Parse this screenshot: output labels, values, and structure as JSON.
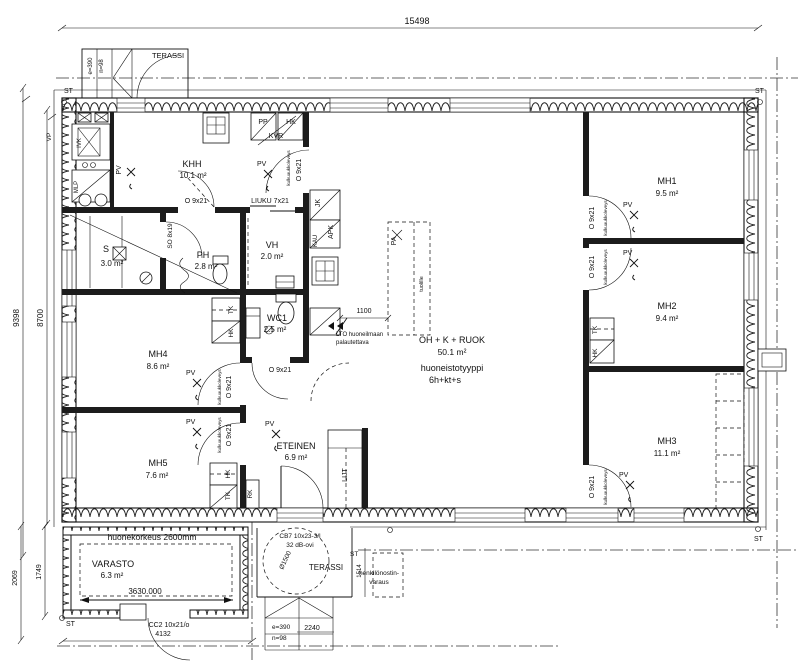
{
  "plan": {
    "dims": {
      "top": "15498",
      "left_outer": "9398",
      "left_inner": "8700",
      "bl_outer": "2069",
      "bl_inner": "1749",
      "kitchen": "1100",
      "lift": "1514",
      "varasto": "3630.000",
      "varasto_door": "4132",
      "terrace": "2240",
      "lift_circle": "Ø1500"
    },
    "rooms": {
      "khh": {
        "name": "KHH",
        "area": "10.1 m²"
      },
      "vh": {
        "name": "VH",
        "area": "2.0 m²"
      },
      "ph": {
        "name": "PH",
        "area": "2.8 m²"
      },
      "s": {
        "name": "S",
        "area": "3.0 m²"
      },
      "wc1": {
        "name": "WC1",
        "area": "2.5 m²"
      },
      "mh1": {
        "name": "MH1",
        "area": "9.5 m²"
      },
      "mh2": {
        "name": "MH2",
        "area": "9.4 m²"
      },
      "mh3": {
        "name": "MH3",
        "area": "11.1 m²"
      },
      "mh4": {
        "name": "MH4",
        "area": "8.6 m²"
      },
      "mh5": {
        "name": "MH5",
        "area": "7.6 m²"
      },
      "eteinen": {
        "name": "ETEINEN",
        "area": "6.9 m²"
      },
      "varasto": {
        "name": "VARASTO",
        "area": "6.3 m²"
      }
    },
    "apartment": {
      "living_name": "OH + K + RUOK",
      "living_area": "50.1 m²",
      "type_label": "huoneistotyyppi",
      "type_value": "6h+kt+s",
      "ceiling_height": "huonekorkeus 2600mm"
    },
    "doors": {
      "o9x21": "O 9x21",
      "liuku": "LIUKU 7x21",
      "so8x19": "SO 8x19",
      "cb7": "CB7 10x23-3/l",
      "cb7_note": "32 dB-ovi",
      "cc2": "CC2 10x21/o",
      "opening_note": "kulkuaukkoleveys"
    },
    "fixtures": {
      "pp": "PP",
      "hk": "HK",
      "kvr": "KVR",
      "jk": "JK",
      "apk": "APK",
      "kau": "KAU",
      "pa": "PA",
      "pa_note": "tuolille",
      "ivk": "IVK",
      "mlp": "MLP",
      "tk": "TK",
      "rk": "RK",
      "lijt": "LIJT",
      "pv": "PV"
    },
    "site": {
      "st": "ST",
      "vp": "VP",
      "terassi": "TERASSI",
      "e": "e=390",
      "n": "n=98",
      "lift_res1": "henkilönostin-",
      "lift_res2": "varaus",
      "lto1": "LTO huoneilmaan",
      "lto2": "palautettava"
    }
  }
}
